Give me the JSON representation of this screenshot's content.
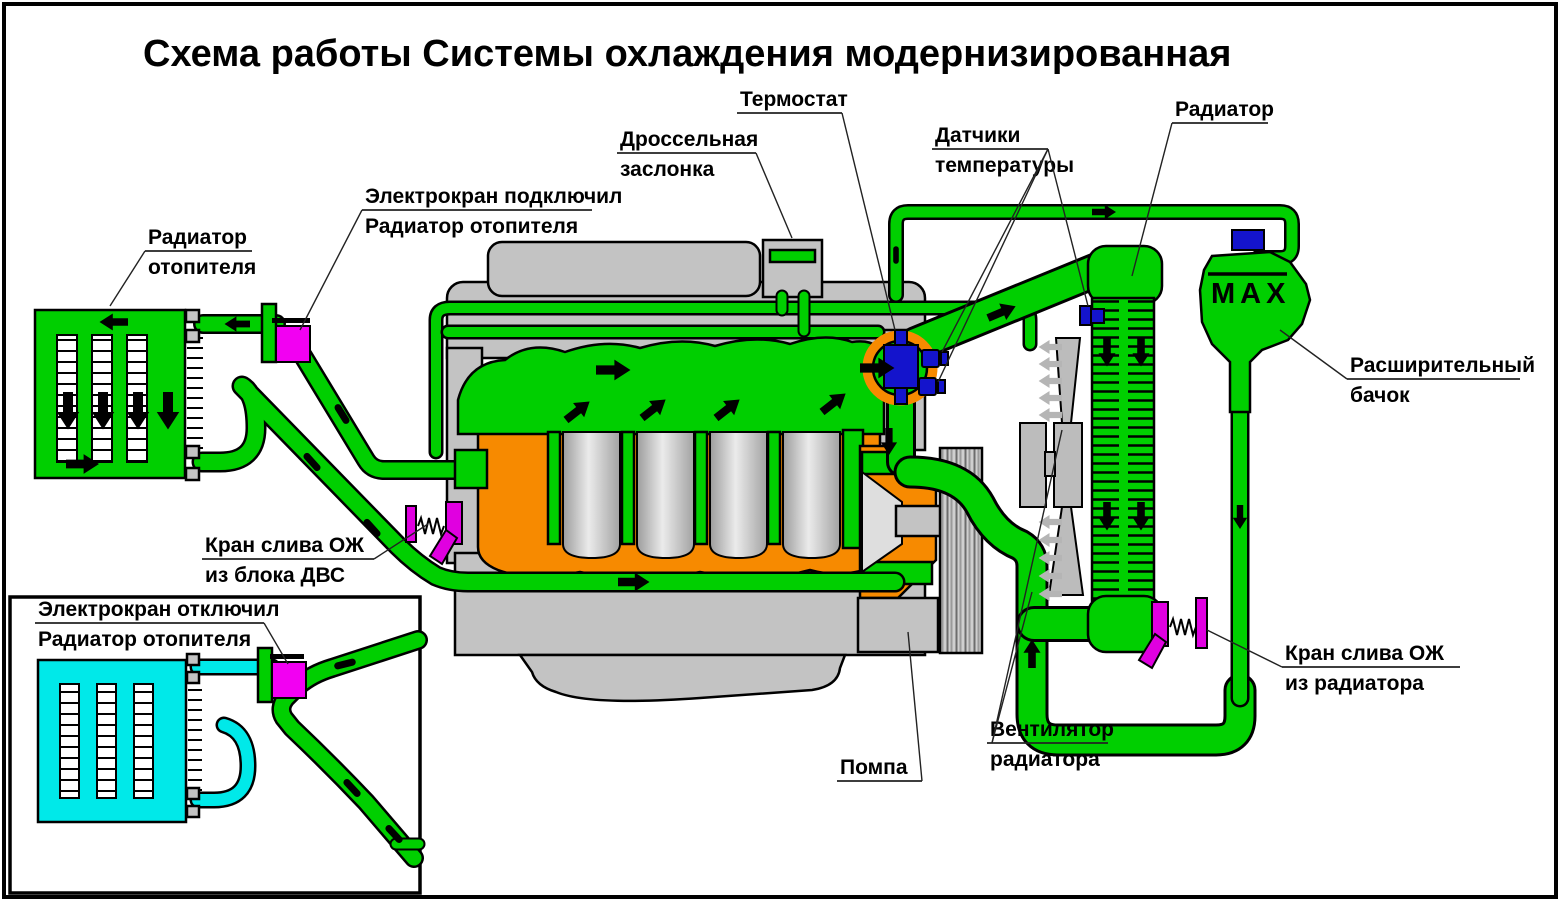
{
  "title": {
    "text": "Схема работы Системы охлаждения модернизированная"
  },
  "labels": {
    "thermostat": {
      "text": "Термостат"
    },
    "throttle": {
      "line1": "Дроссельная",
      "line2": "заслонка"
    },
    "temp_sensors": {
      "line1": "Датчики",
      "line2": "температуры"
    },
    "radiator": {
      "text": "Радиатор"
    },
    "valve_on": {
      "line1": "Электрокран подключил",
      "line2": "Радиатор отопителя"
    },
    "heater_radiator": {
      "line1": "Радиатор",
      "line2": "отопителя"
    },
    "expansion_tank": {
      "line1": "Расширительный",
      "line2": "бачок"
    },
    "engine_drain": {
      "line1": "Кран слива ОЖ",
      "line2": "из блока ДВС"
    },
    "valve_off": {
      "line1": "Электрокран отключил",
      "line2": "Радиатор отопителя"
    },
    "pump": {
      "text": "Помпа"
    },
    "fan": {
      "line1": "Вентилятор",
      "line2": "радиатора"
    },
    "radiator_drain": {
      "line1": "Кран слива ОЖ",
      "line2": "из радиатора"
    },
    "max_mark": {
      "text": "MAX"
    }
  },
  "colors": {
    "background": "#ffffff",
    "outline": "#000000",
    "coolant_green": "#00cf00",
    "coolant_cyan": "#00e9e9",
    "valve_magenta": "#f200f2",
    "drain_magenta": "#e000e0",
    "metal_orange": "#f78a00",
    "engine_gray": "#c3c3c3",
    "part_blue": "#1414cc",
    "fan_gray": "#bcbcbc",
    "air_gray": "#b5b5b5",
    "label_black": "#000000"
  }
}
